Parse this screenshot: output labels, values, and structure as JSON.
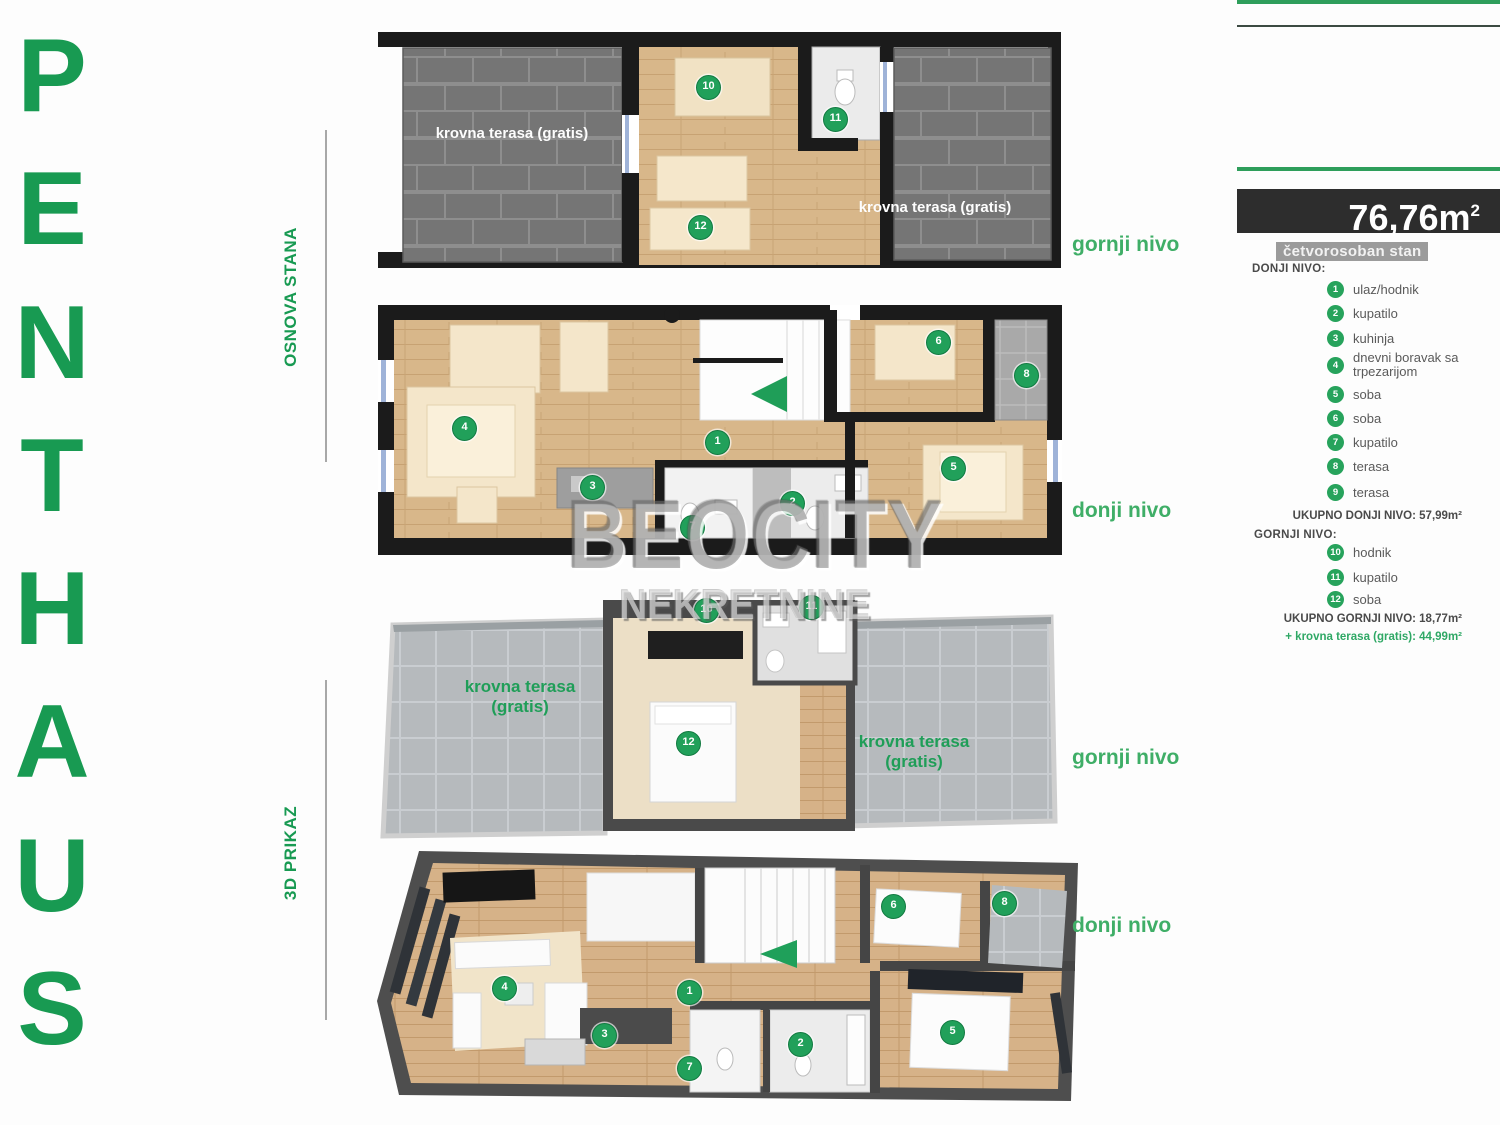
{
  "brand": {
    "letters": [
      "P",
      "E",
      "N",
      "T",
      "H",
      "A",
      "U",
      "S"
    ]
  },
  "sections": {
    "osnova": "OSNOVA STANA",
    "prikaz": "3D PRIKAZ"
  },
  "levels": {
    "gornji": "gornji nivo",
    "donji": "donji nivo"
  },
  "terrace": {
    "full": "krovna terasa (gratis)",
    "line1": "krovna terasa",
    "line2": "(gratis)"
  },
  "watermark": {
    "line1": "BEOCITY",
    "line2": "NEKRETNINE"
  },
  "markers": {
    "osnova_gornji": [
      "10",
      "11",
      "12"
    ],
    "osnova_donji": [
      "4",
      "3",
      "1",
      "7",
      "2",
      "6",
      "8",
      "5"
    ],
    "prikaz_gornji": [
      "10",
      "11",
      "12"
    ],
    "prikaz_donji": [
      "4",
      "3",
      "1",
      "7",
      "2",
      "6",
      "8",
      "5"
    ]
  },
  "panel": {
    "area_value": "76,76m",
    "area_sup": "2",
    "type_badge": "četvorosoban stan",
    "lower_header": "DONJI NIVO:",
    "lower_items": [
      {
        "num": "1",
        "label": "ulaz/hodnik"
      },
      {
        "num": "2",
        "label": "kupatilo"
      },
      {
        "num": "3",
        "label": "kuhinja"
      },
      {
        "num": "4",
        "label": "dnevni boravak sa trpezarijom"
      },
      {
        "num": "5",
        "label": "soba"
      },
      {
        "num": "6",
        "label": "soba"
      },
      {
        "num": "7",
        "label": "kupatilo"
      },
      {
        "num": "8",
        "label": "terasa"
      },
      {
        "num": "9",
        "label": "terasa"
      }
    ],
    "lower_total": "UKUPNO DONJI NIVO: 57,99m²",
    "upper_header": "GORNJI NIVO:",
    "upper_items": [
      {
        "num": "10",
        "label": "hodnik"
      },
      {
        "num": "11",
        "label": "kupatilo"
      },
      {
        "num": "12",
        "label": "soba"
      }
    ],
    "upper_total": "UKUPNO GORNJI NIVO: 18,77m²",
    "terrace_total": "+ krovna terasa (gratis): 44,99m²"
  }
}
